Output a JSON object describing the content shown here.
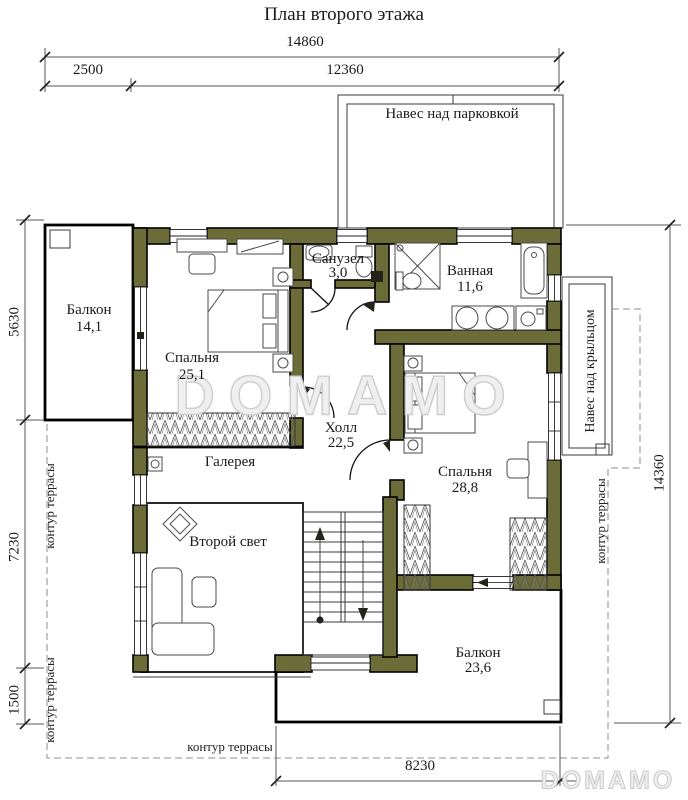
{
  "page": {
    "title": "План второго этажа"
  },
  "dimensions": {
    "top_total": "14860",
    "top_left": "2500",
    "top_right": "12360",
    "left_upper": "5630",
    "left_middle": "7230",
    "left_lower": "1500",
    "right_total": "14360",
    "bottom": "8230"
  },
  "annotations": {
    "parking_canopy": "Навес над парковкой",
    "porch_canopy": "Навес над крыльцом",
    "terrace_left_upper": "контур террасы",
    "terrace_left_lower": "контур террасы",
    "terrace_right": "контур террасы",
    "terrace_bottom": "контур террасы"
  },
  "rooms": {
    "balcony_left": {
      "name": "Балкон",
      "area": "14,1"
    },
    "bedroom_left": {
      "name": "Спальня",
      "area": "25,1"
    },
    "wc": {
      "name": "Санузел",
      "area": "3,0"
    },
    "bathroom": {
      "name": "Ванная",
      "area": "11,6"
    },
    "hall": {
      "name": "Холл",
      "area": "22,5"
    },
    "gallery": {
      "name": "Галерея"
    },
    "second_light": {
      "name": "Второй свет"
    },
    "bedroom_right": {
      "name": "Спальня",
      "area": "28,8"
    },
    "balcony_bottom": {
      "name": "Балкон",
      "area": "23,6"
    }
  },
  "watermark": {
    "center": "DOMAMO",
    "logo": "DOMAMO"
  },
  "colors": {
    "wall": "#6c6c38",
    "line": "#1a1a1a",
    "dashed_contour": "#8d8d8d",
    "watermark": "#cdcdcd"
  }
}
